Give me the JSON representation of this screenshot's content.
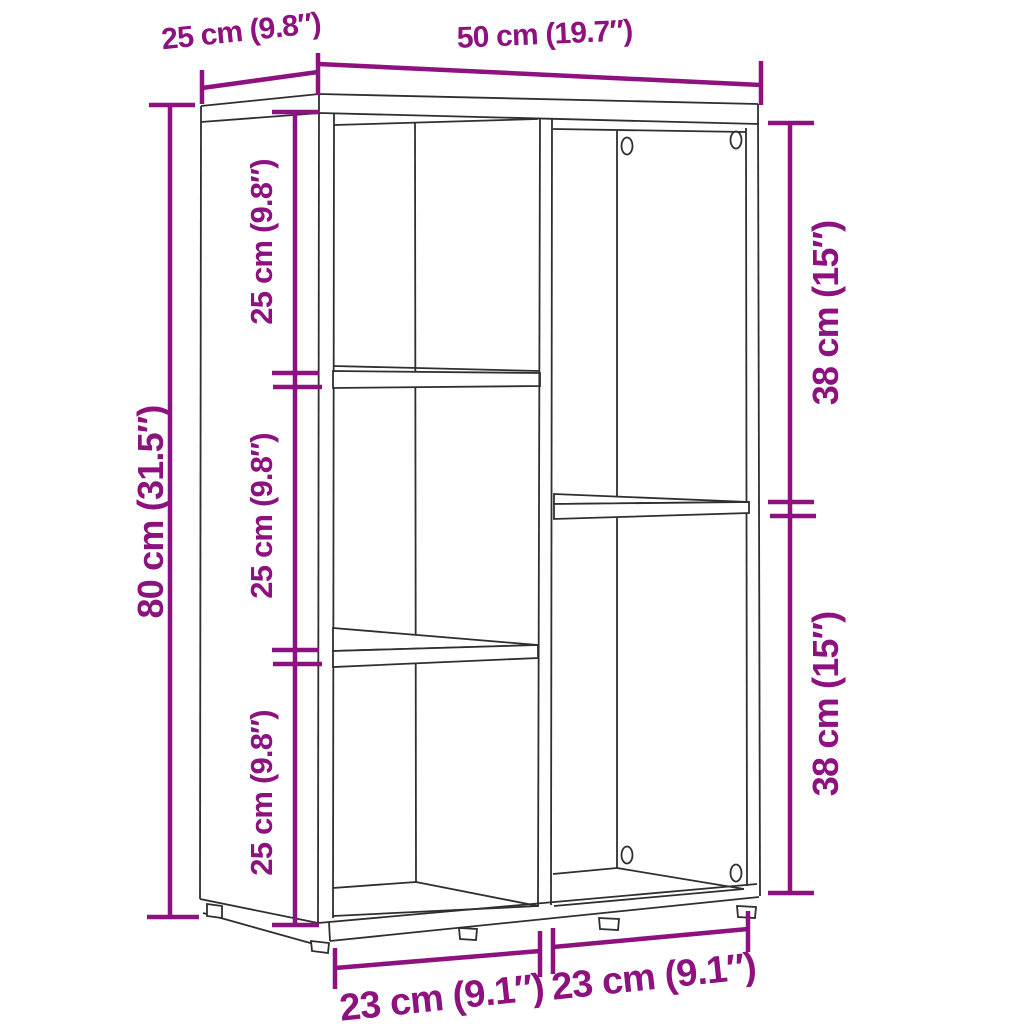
{
  "diagram": {
    "type": "furniture-dimension-diagram",
    "subject": "5-compartment bookshelf / cabinet line drawing",
    "colors": {
      "dimension": "#8D117F",
      "outline": "#2F2F2F",
      "background": "#FFFFFF"
    },
    "labels": {
      "depth": "25 cm (9.8″)",
      "width": "50 cm (19.7″)",
      "height": "80 cm (31.5″)",
      "left_shelf_sections": [
        "25 cm (9.8″)",
        "25 cm (9.8″)",
        "25 cm (9.8″)"
      ],
      "right_shelf_sections": [
        "38 cm (15″)",
        "38 cm (15″)"
      ],
      "bottom_widths": [
        "23 cm (9.1″)",
        "23 cm (9.1″)"
      ]
    }
  }
}
